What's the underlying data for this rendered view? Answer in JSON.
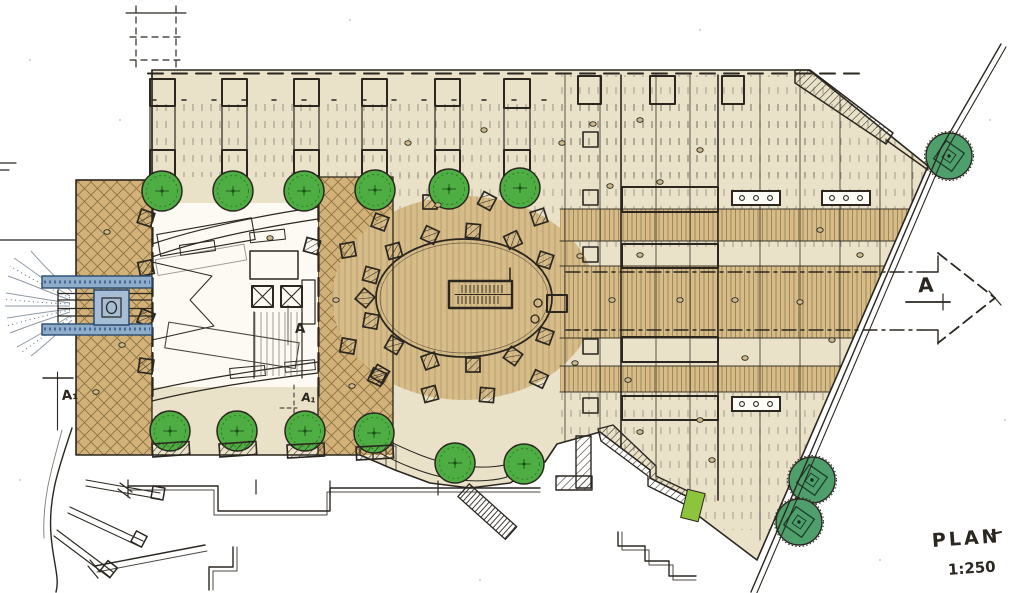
{
  "title_block": {
    "title": "PLAN",
    "scale": "1:250"
  },
  "section_markers": {
    "right_arrow": "A",
    "left_marker": "A₁",
    "court_upper": "A",
    "court_lower": "A₁"
  },
  "colors": {
    "paper": "#ffffff",
    "plaza_cream": "#e9e1c8",
    "paving_tan": "#d7bc87",
    "crosshatch_tan": "#d2b279",
    "tree_green": "#4fae43",
    "tree_dark_green": "#4f9f6c",
    "planter_green": "#9cc83b",
    "water_blue": "#8fadc9",
    "water_outline": "#2a4a70",
    "ink": "#2b2720"
  }
}
